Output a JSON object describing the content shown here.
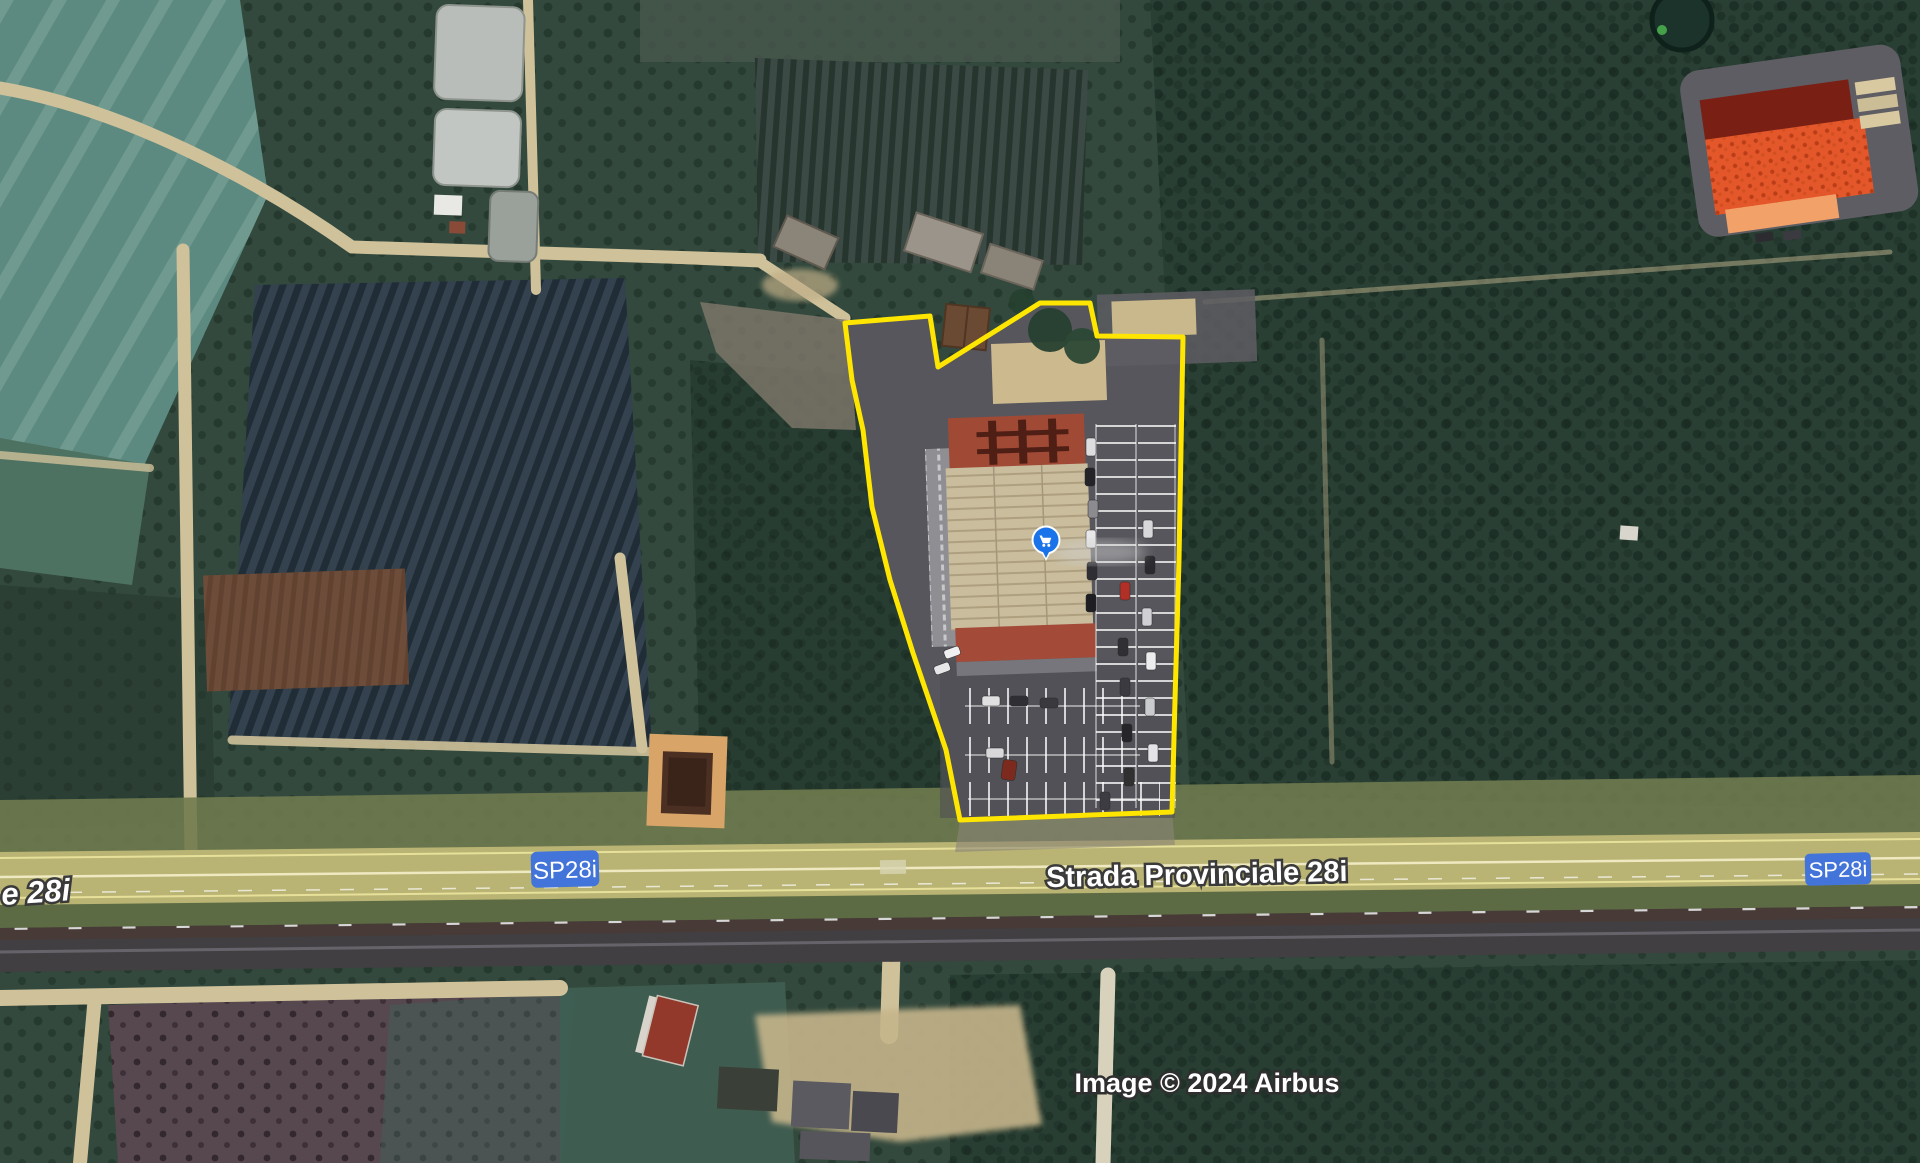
{
  "map": {
    "attribution": "Image © 2024 Airbus",
    "road": {
      "name": "Strada Provinciale 28i",
      "name_partial_left": "e 28i",
      "shield_label": "SP28i",
      "shield_color": "#4274d9",
      "label_color": "#ffffff"
    },
    "parcel": {
      "outline_color": "#ffe600",
      "outline_points": "845,323 930,316 938,367 1040,303 1090,303 1097,336 1183,337 1179,560 1175,700 1172,812 960,820 946,750 913,653 890,580 872,507 863,430 852,380"
    },
    "poi": {
      "icon": "shopping-cart-icon",
      "pin_color": "#1a73e8",
      "transform": "translate(1046,540)"
    }
  }
}
